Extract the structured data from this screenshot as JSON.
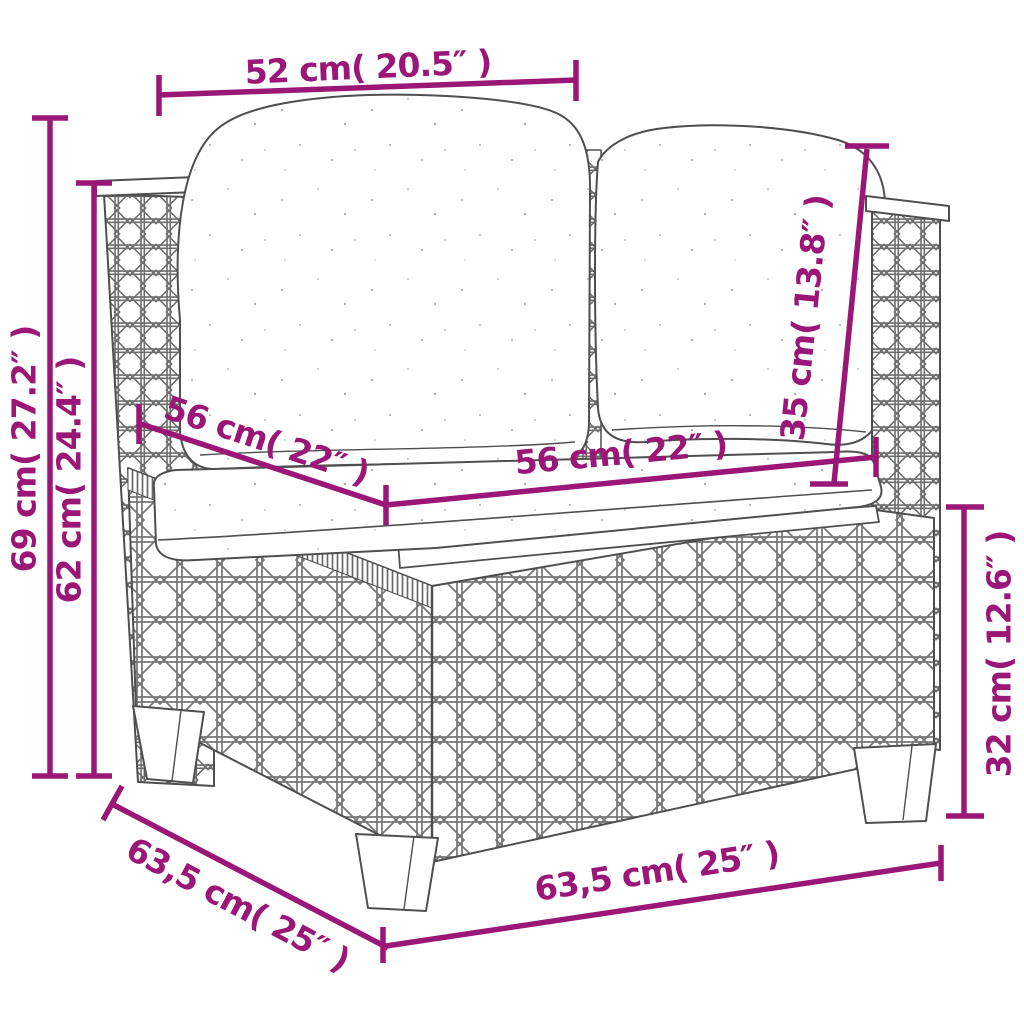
{
  "diagram": {
    "type": "product-dimension-drawing",
    "subject": "rattan-corner-sofa-section",
    "colors": {
      "accent": "#9A1778",
      "outline": "#4f4f4f",
      "weave": "#757575",
      "background": "#ffffff"
    },
    "dimensions": {
      "top_back_width": "52 cm( 20.5″ )",
      "total_height": "69 cm( 27.2″ )",
      "back_height": "62 cm( 24.4″ )",
      "seat_depth": "56 cm( 22″ )",
      "seat_width": "56 cm( 22″ )",
      "back_cushion_height": "35 cm( 13.8″ )",
      "base_height": "32 cm( 12.6″ )",
      "bottom_depth": "63,5 cm( 25″ )",
      "bottom_width": "63,5 cm( 25″ )"
    }
  }
}
